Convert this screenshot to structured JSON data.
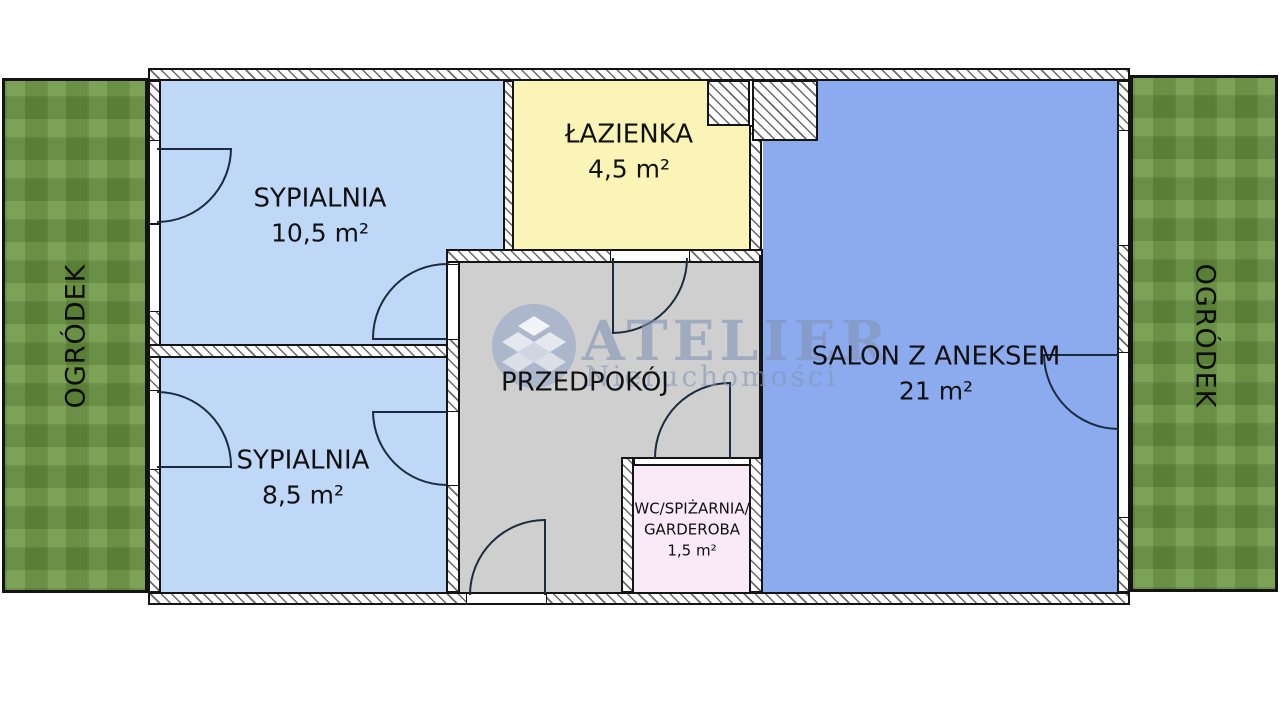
{
  "plan": {
    "title": "apartment-floor-plan",
    "gardens": {
      "left_label": "OGRÓDEK",
      "right_label": "OGRÓDEK",
      "color": "#6d9743"
    },
    "rooms": {
      "bedroom1": {
        "name": "SYPIALNIA",
        "area": "10,5 m²",
        "color": "#bfd8f8"
      },
      "bedroom2": {
        "name": "SYPIALNIA",
        "area": "8,5 m²",
        "color": "#bfd8f8"
      },
      "bathroom": {
        "name": "ŁAZIENKA",
        "area": "4,5 m²",
        "color": "#faf4b6"
      },
      "hallway": {
        "name": "PRZEDPOKÓJ",
        "color": "#cfcfcf"
      },
      "living": {
        "name": "SALON Z ANEKSEM",
        "area": "21 m²",
        "color": "#8cabef"
      },
      "wc": {
        "name_line1": "WC/SPIŻARNIA/",
        "name_line2": "GARDEROBA",
        "area": "1,5 m²",
        "color": "#fae9f7"
      }
    },
    "watermark": {
      "brand": "ATELIER",
      "subtitle": "Nieruchomości",
      "color": "#8894b8"
    },
    "wall_color": "#141414",
    "door_line_color": "#1c2b3d"
  }
}
